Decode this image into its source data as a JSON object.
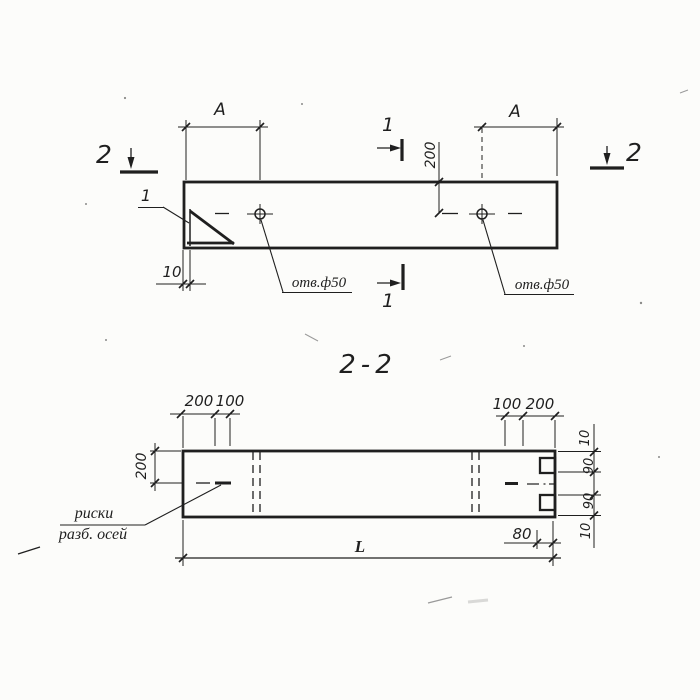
{
  "colors": {
    "ink": "#1f1f1f",
    "paper": "#fcfcfa",
    "faint": "#9a9a9a"
  },
  "plan_view": {
    "dim_a_left": "A",
    "dim_a_right": "A",
    "dim_offset_200": "200",
    "dim_plate_10": "10",
    "hole_label_left": "отв.ф50",
    "hole_label_right": "отв.ф50",
    "detail_callout": "1",
    "section_mark_1": "1",
    "section_mark_2": "2"
  },
  "section_view": {
    "title": "2-2",
    "dim_top_left_200": "200",
    "dim_top_left_100": "100",
    "dim_top_right_100": "100",
    "dim_top_right_200": "200",
    "dim_height_200": "200",
    "dim_right_10_top": "10",
    "dim_right_90_top": "90",
    "dim_right_90_bottom": "90",
    "dim_right_10_bottom": "10",
    "dim_notch_80": "80",
    "dim_length": "L",
    "axis_note_line1": "риски",
    "axis_note_line2": "разб. осей"
  }
}
